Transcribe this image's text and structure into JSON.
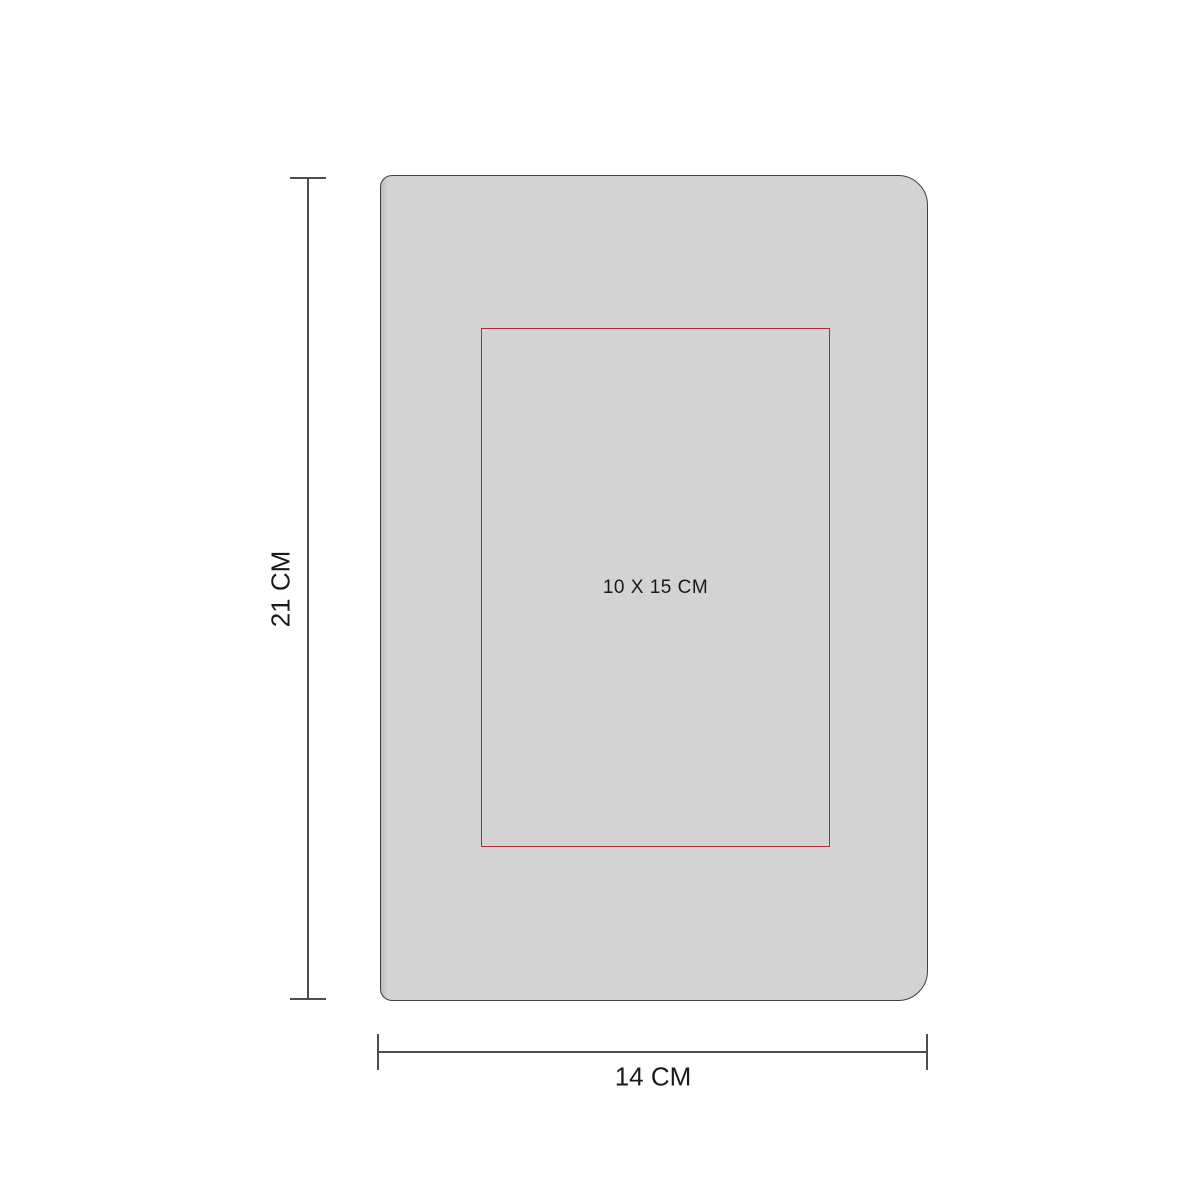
{
  "diagram": {
    "product": {
      "kind": "notebook-front-view",
      "fill_color": "#d3d3d3",
      "outline_color": "#404040"
    },
    "print_area": {
      "label": "10 X 15 CM",
      "border_color": "#b02d33"
    },
    "height_dimension": {
      "label": "21 CM"
    },
    "width_dimension": {
      "label": "14 CM"
    },
    "dimension_line_color": "#4d4d4d",
    "text_color": "#1a1a1a",
    "background_color": "#ffffff"
  }
}
